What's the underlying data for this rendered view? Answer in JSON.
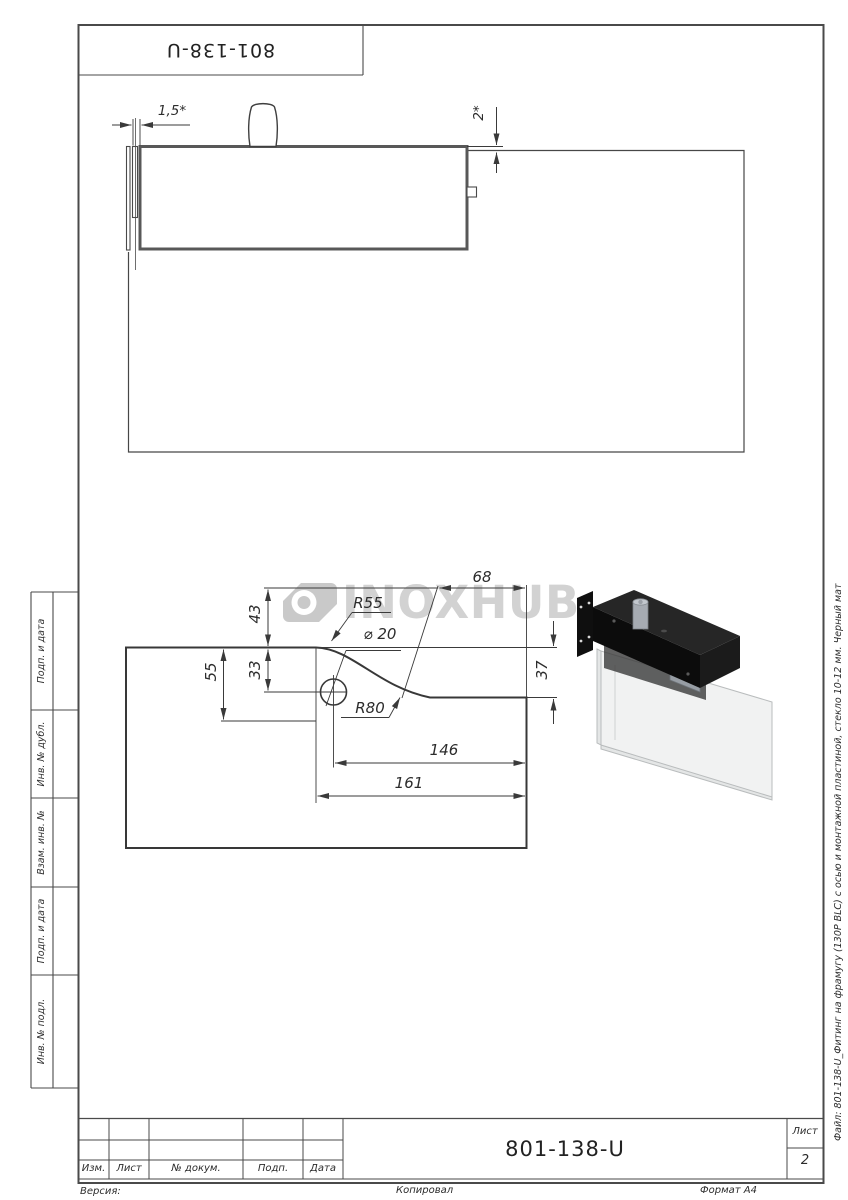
{
  "sheet": {
    "top_designation": "801-138-U",
    "designation": "801-138-U",
    "sheet_word": "Лист",
    "sheet_number": "2",
    "version_label": "Версия:",
    "copied_label": "Копировал",
    "format_label": "Формат A4",
    "file_note": "Файл: 801-138-U_Фитинг на фрамугу (130P BLC) с осью и монтажной пластиной, стекло 10-12 мм. Черный мат"
  },
  "title_block": {
    "columns": [
      "Изм.",
      "Лист",
      "№ докум.",
      "Подп.",
      "Дата"
    ]
  },
  "side_strip": {
    "labels": [
      "Подп. и дата",
      "Инв. № дубл.",
      "Взам. инв. №",
      "Подп. и дата",
      "Инв. № подл."
    ]
  },
  "watermark": {
    "text": "INOXHUB"
  },
  "dims": {
    "top": {
      "gap": "1,5*",
      "offset": "2*"
    },
    "profile": {
      "h43": "43",
      "h33": "33",
      "h55": "55",
      "h37": "37",
      "w68": "68",
      "w146": "146",
      "w161": "161",
      "r55": "R55",
      "r80": "R80",
      "dia": "⌀ 20"
    }
  },
  "colors": {
    "line": "#3a3a3a",
    "thick": "#555555",
    "watermark": "#d2d2d2",
    "fitting_black": "#0c0c0c",
    "glass_3d": "#f1f2f2",
    "pin_gray": "#a6abb2"
  }
}
